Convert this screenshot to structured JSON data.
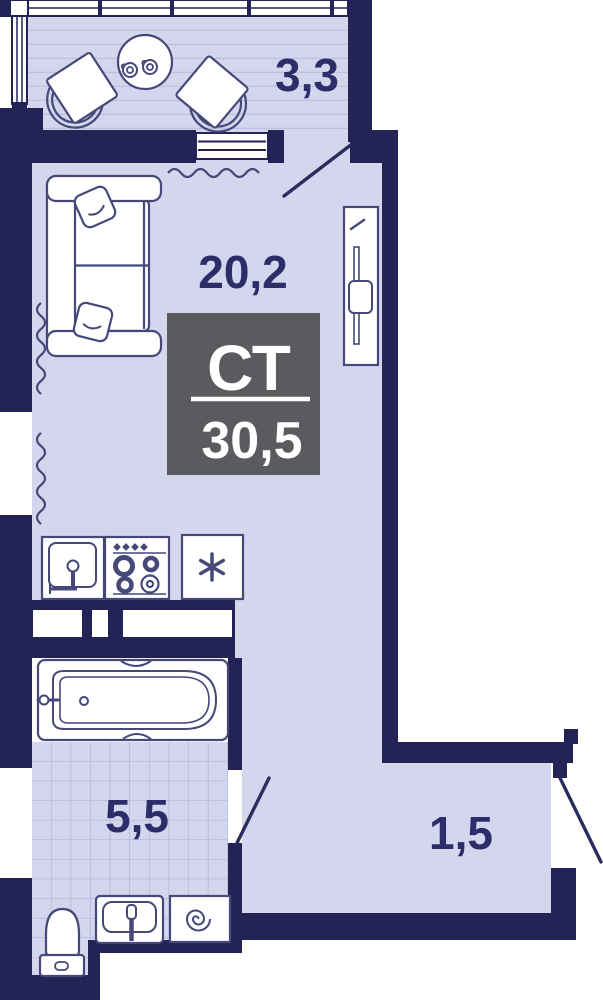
{
  "floor_plan": {
    "badge": {
      "type": "СТ",
      "total_area": "30,5"
    },
    "rooms": {
      "balcony": {
        "area": "3,3"
      },
      "living_room": {
        "area": "20,2"
      },
      "bathroom": {
        "area": "5,5"
      },
      "hallway": {
        "area": "1,5"
      }
    },
    "colors": {
      "wall": "#242355",
      "floor": "#d3d6ec",
      "outline": "#454879",
      "door": "#2b2c5e",
      "label_text": "#2b2e68",
      "badge_background": "#5a5a5f",
      "badge_text": "#ffffff",
      "tile_line": "#a8add6",
      "deck_line": "#bcc1de"
    },
    "icons": [
      "snowflake-icon"
    ]
  }
}
